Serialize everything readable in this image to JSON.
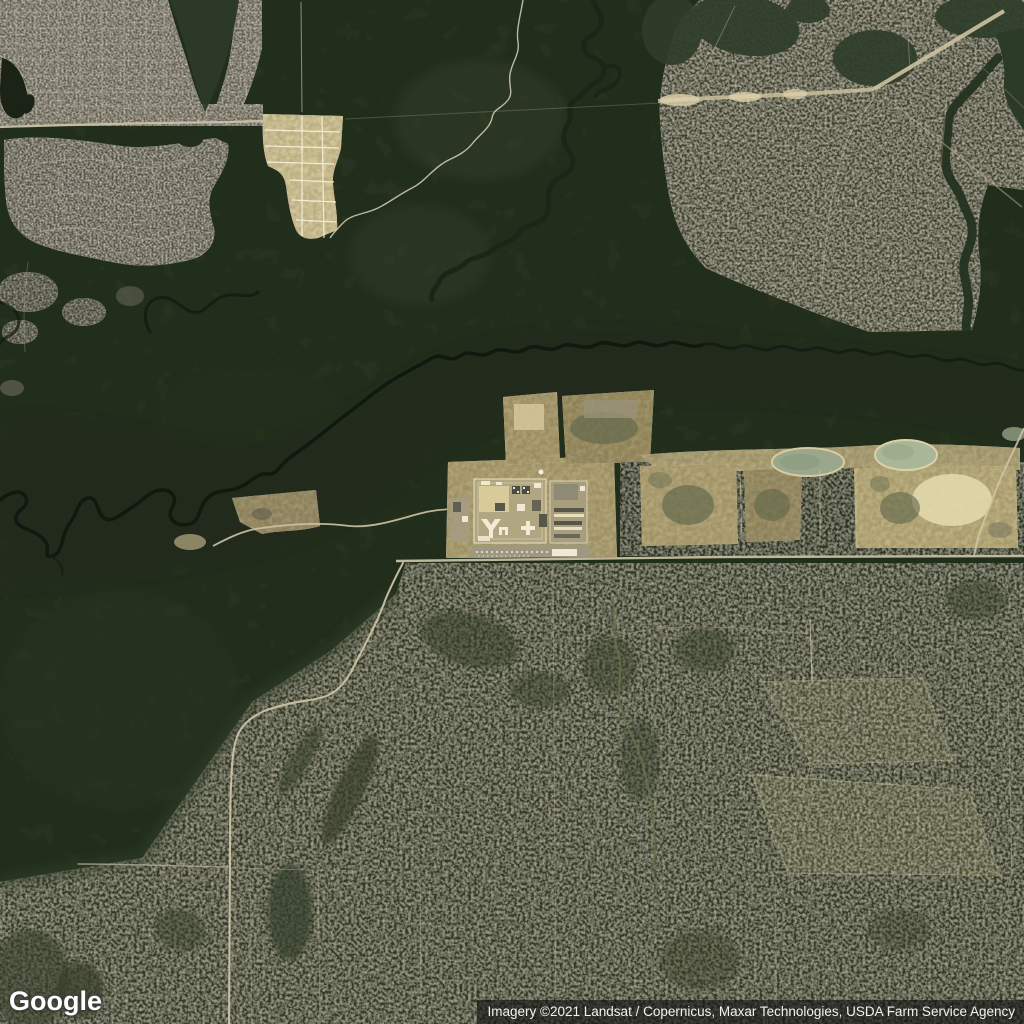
{
  "map": {
    "view_type": "satellite",
    "logo": {
      "text": "Google"
    },
    "attribution": {
      "text": "Imagery ©2021 Landsat / Copernicus, Maxar Technologies, USDA Farm Service Agency"
    },
    "palette": {
      "forest_dark": "#2f3b29",
      "swamp_dark": "#202b1a",
      "river_channel": "#101910",
      "scrubland": "#4c5239",
      "northeast_scrub": "#5d604a",
      "suburb_gray": "#8f8a7a",
      "subdivision_tan": "#e9ddb4",
      "facility_dirt": "#c6b88d",
      "building_white": "#f2ecd6",
      "road_tan": "#ccc3a5",
      "pond_gray_green": "#9aa78c",
      "attribution_bg_rgba": "rgba(18,18,18,0.64)",
      "attribution_text": "#f2f2f2"
    },
    "features": [
      "suburban-neighborhood-top-left",
      "dark-lake",
      "golf-course-development",
      "bright-new-subdivision",
      "forest-with-meandering-river",
      "creek-top-center",
      "prison-like-facility-complex-center",
      "cleared-lots-and-borrow-ponds-east-strip",
      "east-west-road",
      "southwest-access-road",
      "scrubland-bottom-half",
      "two-cleared-fields-bottom-right",
      "trail-grid-bottom"
    ]
  }
}
